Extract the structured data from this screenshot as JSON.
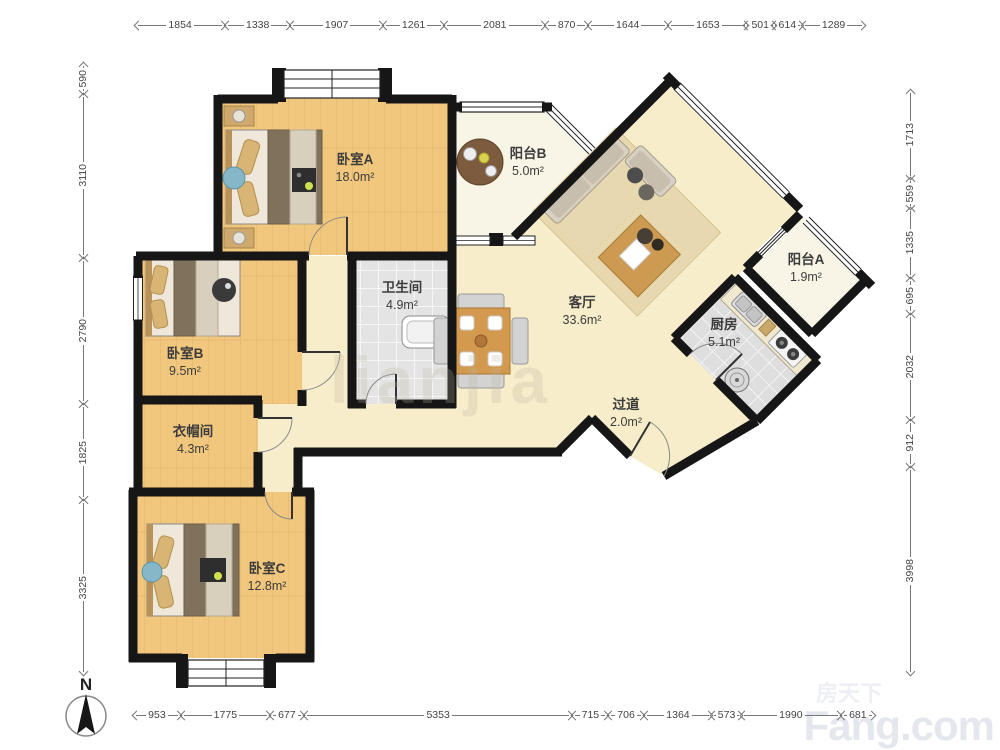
{
  "compass": {
    "label": "N"
  },
  "watermarks": {
    "center": "lianjia",
    "brand_cn": "房天下",
    "brand_en": "Fang.com"
  },
  "colors": {
    "wall": "#161616",
    "wood_floor": "#f1c77e",
    "hall_floor": "#f7edca",
    "tile_floor": "#e4e4e4",
    "balcony_floor": "#f9f5e6",
    "dimension_line": "#777777"
  },
  "rooms": [
    {
      "id": "bedroom-a",
      "name": "卧室A",
      "area": "18.0m²"
    },
    {
      "id": "balcony-b",
      "name": "阳台B",
      "area": "5.0m²"
    },
    {
      "id": "living-room",
      "name": "客厅",
      "area": "33.6m²"
    },
    {
      "id": "balcony-a",
      "name": "阳台A",
      "area": "1.9m²"
    },
    {
      "id": "kitchen",
      "name": "厨房",
      "area": "5.1m²"
    },
    {
      "id": "bathroom",
      "name": "卫生间",
      "area": "4.9m²"
    },
    {
      "id": "bedroom-b",
      "name": "卧室B",
      "area": "9.5m²"
    },
    {
      "id": "closet",
      "name": "衣帽间",
      "area": "4.3m²"
    },
    {
      "id": "hallway",
      "name": "过道",
      "area": "2.0m²"
    },
    {
      "id": "bedroom-c",
      "name": "卧室C",
      "area": "12.8m²"
    }
  ],
  "dimensions": {
    "top": [
      "1854",
      "1338",
      "1907",
      "1261",
      "2081",
      "870",
      "1644",
      "1653",
      "501",
      "614",
      "1289"
    ],
    "bottom": [
      "953",
      "1775",
      "677",
      "5353",
      "715",
      "706",
      "1364",
      "573",
      "1990",
      "681"
    ],
    "left": [
      "590",
      "3110",
      "2790",
      "1825",
      "3325"
    ],
    "right": [
      "1713",
      "559",
      "1335",
      "695",
      "2032",
      "912",
      "3998"
    ]
  }
}
